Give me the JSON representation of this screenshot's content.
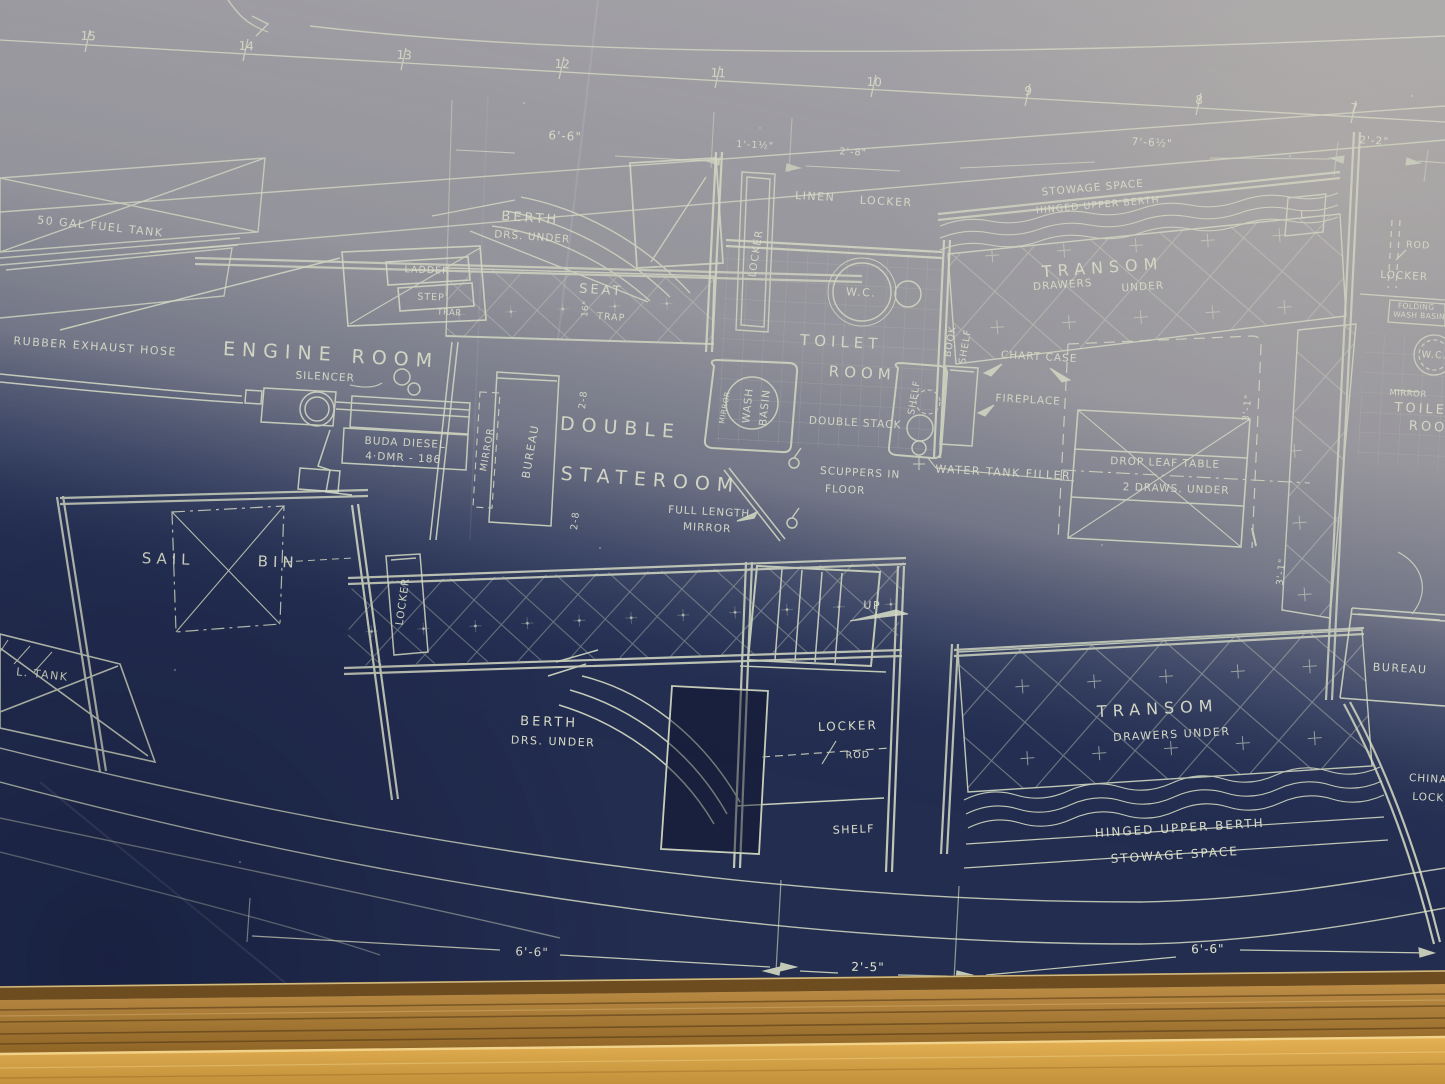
{
  "colors": {
    "blueprint_navy": "#232d50",
    "glare_gray": "#a8a6a9",
    "line_cream": "#dfe5c9",
    "text_cream": "#e9ecd2",
    "frame_gold": "#d2a449",
    "frame_dark": "#8f6526"
  },
  "plan": {
    "stations": [
      "15",
      "14",
      "13",
      "12",
      "11",
      "10",
      "9",
      "8",
      "7"
    ],
    "dims_top": [
      "6'-6\"",
      "1'-1½\"",
      "2'-8\"",
      "7'-6½\"",
      "2'-2\""
    ],
    "dims_bottom": [
      "6'-6\"",
      "2'-5\"",
      "6'-6\""
    ],
    "small_dims": {
      "d28": "2-8",
      "d16": "16\"",
      "d31": "3'-1\""
    },
    "fuel": {
      "tank": "50 GAL FUEL TANK",
      "exhaust": "RUBBER EXHAUST HOSE",
      "tank_aft": "L. TANK"
    },
    "engine_room": {
      "title1": "ENGINE",
      "title2": "ROOM",
      "silencer": "SILENCER",
      "engine1": "BUDA DIESEL",
      "engine2": "4·DMR - 186"
    },
    "companionway": {
      "ladder": "LADDER",
      "step": "STEP",
      "trap": "TRAP"
    },
    "fwd_cabin": {
      "berth": "BERTH",
      "drs_under": "DRS. UNDER",
      "seat": "SEAT",
      "trap": "TRAP",
      "locker": "LOCKER"
    },
    "stateroom": {
      "double": "DOUBLE",
      "stateroom": "STATEROOM",
      "bureau": "BUREAU",
      "mirror": "MIRROR",
      "full_length_1": "FULL LENGTH",
      "full_length_2": "MIRROR",
      "wash": "WASH",
      "basin": "BASIN",
      "mirror_small": "MIRROR",
      "scuppers_1": "SCUPPERS IN",
      "scuppers_2": "FLOOR",
      "up": "UP"
    },
    "toilet": {
      "linen": "LINEN",
      "locker": "LOCKER",
      "wc": "W.C.",
      "toilet": "TOILET",
      "room": "ROOM",
      "double_stack": "DOUBLE STACK",
      "shelf": "SHELF",
      "book": "BOOK",
      "book_shelf": "SHELF",
      "chart_case": "CHART CASE",
      "fireplace": "FIREPLACE",
      "water_tank_filler": "WATER TANK FILLER"
    },
    "saloon": {
      "stowage_space": "STOWAGE SPACE",
      "hinged_upper_berth": "HINGED UPPER BERTH",
      "transom": "TRANSOM",
      "drawers": "DRAWERS",
      "under": "UNDER",
      "l_box": "L.",
      "drop_leaf_1": "DROP LEAF TABLE",
      "drop_leaf_2": "2 DRAWS. UNDER",
      "transom_aft": "TRANSOM",
      "drawers_under": "DRAWERS  UNDER",
      "hinged_aft": "HINGED UPPER BERTH",
      "stowage_aft": "STOWAGE SPACE"
    },
    "aft_head": {
      "rod": "ROD",
      "locker": "LOCKER",
      "folding_1": "FOLDING",
      "folding_2": "WASH BASIN",
      "wc": "W.C.",
      "mirror": "MIRROR",
      "toilet": "TOILET",
      "room": "ROOM"
    },
    "aft_cabin": {
      "locker": "LOCKER",
      "rod": "ROD",
      "shelf": "SHELF",
      "berth": "BERTH",
      "drs_under": "DRS. UNDER",
      "bureau": "BUREAU",
      "china_1": "CHINA",
      "china_2": "LOCKER"
    },
    "sail_bin": {
      "sail": "SAIL",
      "bin": "BIN",
      "locker": "LOCKER"
    }
  }
}
